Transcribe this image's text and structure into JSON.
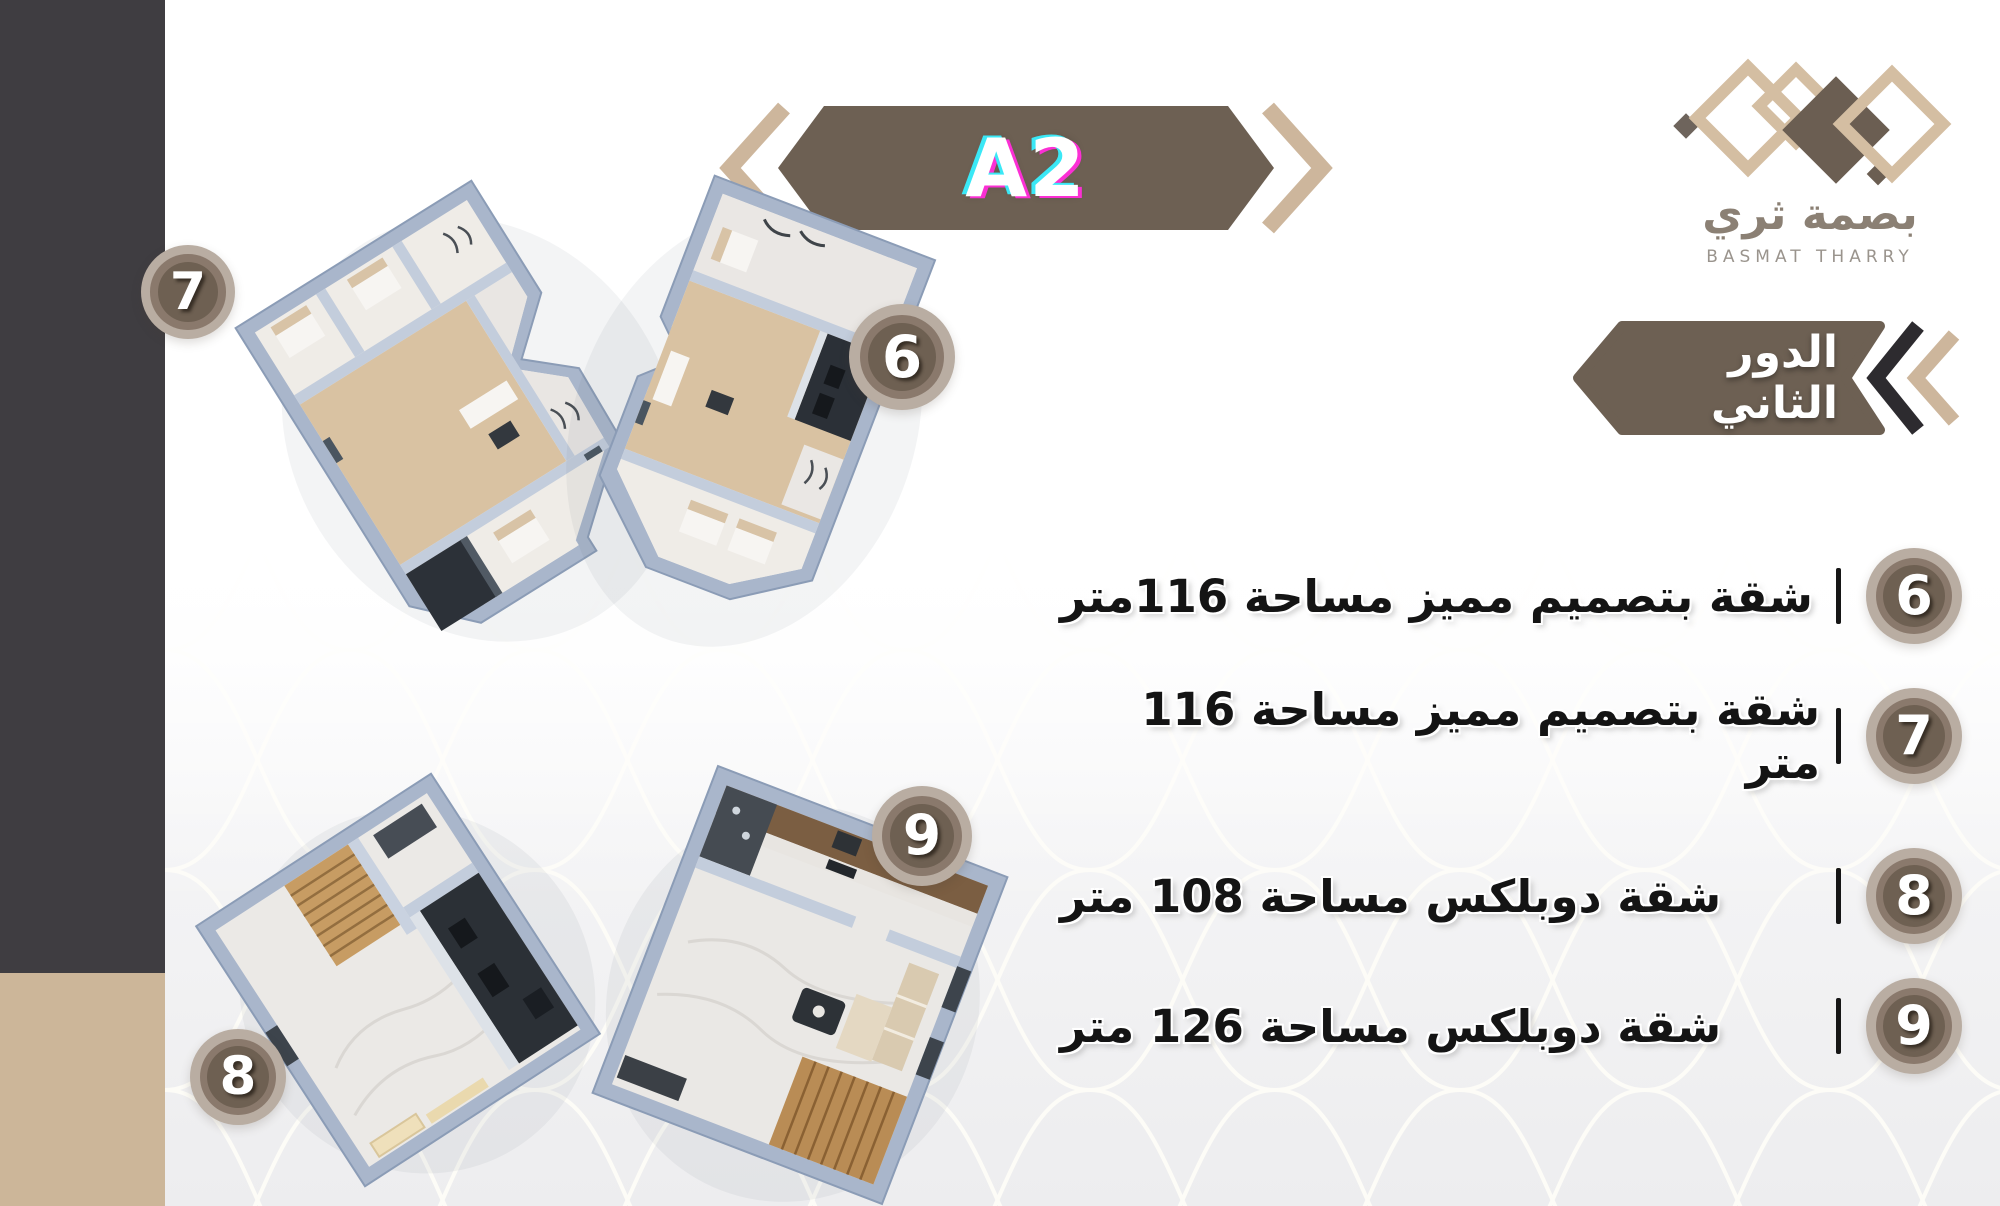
{
  "slide": {
    "unit_banner": "A2",
    "floor_banner": "الدور الثاني"
  },
  "logo": {
    "arabic": "بصمة ثري",
    "english": "BASMAT THARRY"
  },
  "plan_badges": {
    "p7": "7",
    "p6": "6",
    "p8": "8",
    "p9": "9"
  },
  "apartments": [
    {
      "badge": "6",
      "description": "شقة بتصميم مميز مساحة 116متر"
    },
    {
      "badge": "7",
      "description": "شقة بتصميم مميز مساحة 116 متر"
    },
    {
      "badge": "8",
      "description": "شقة دوبلكس مساحة 108 متر"
    },
    {
      "badge": "9",
      "description": "شقة دوبلكس مساحة 126 متر"
    }
  ],
  "colors": {
    "banner_brown": "#6d6053",
    "accent_tan": "#cdb69c",
    "sidebar_dark": "#3f3d41",
    "sidebar_tan": "#ccb699",
    "badge_outer": "#b9ada2",
    "badge_mid": "#8a796c",
    "badge_inner": "#6e6052",
    "chroma_cyan": "#3ae8f6",
    "chroma_magenta": "#fb2fd4",
    "plan_wall": "#a9b6cb",
    "plan_wood_floor": "#d9c2a2",
    "plan_marble_floor": "#eae8e5",
    "plan_kitchen_dark": "#2b3037"
  }
}
